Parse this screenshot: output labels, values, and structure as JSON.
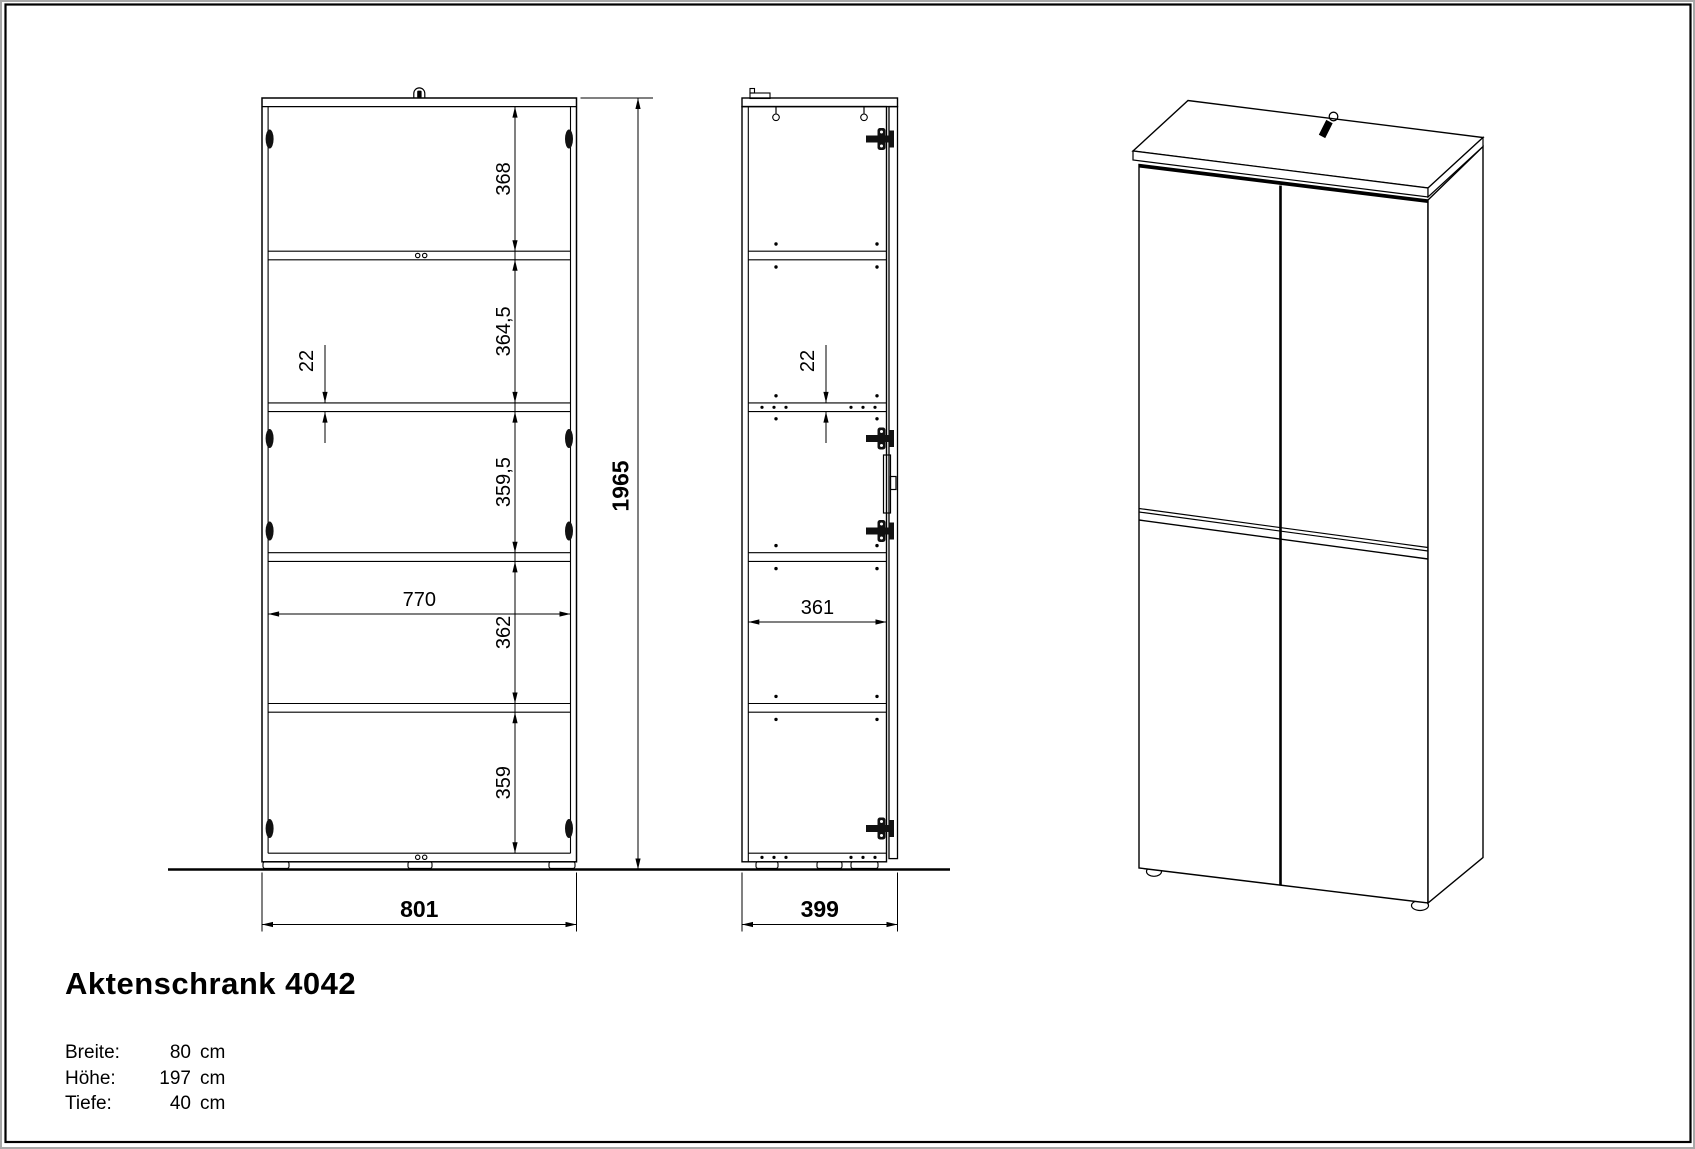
{
  "sheet": {
    "colors": {
      "line": "#000000",
      "background": "#ffffff",
      "frame_gray": "#a8a8a8"
    }
  },
  "title_block": {
    "title": "Aktenschrank 4042",
    "specs": [
      {
        "label": "Breite:",
        "value": "80",
        "unit": "cm"
      },
      {
        "label": "Höhe:",
        "value": "197",
        "unit": "cm"
      },
      {
        "label": "Tiefe:",
        "value": "40",
        "unit": "cm"
      }
    ]
  },
  "views": {
    "front": {
      "name": "front elevation",
      "dims": {
        "chain_dims": [
          "368",
          "364,5",
          "359,5",
          "362",
          "359"
        ],
        "shelf_thickness_dim": "22",
        "inner_width_dim": "770",
        "height_dim": "1965",
        "width_dim": "801"
      }
    },
    "side": {
      "name": "side section",
      "dims": {
        "shelf_thickness_dim": "22",
        "inner_depth_dim": "361",
        "depth_dim": "399"
      }
    },
    "iso": {
      "name": "3d perspective view"
    }
  }
}
